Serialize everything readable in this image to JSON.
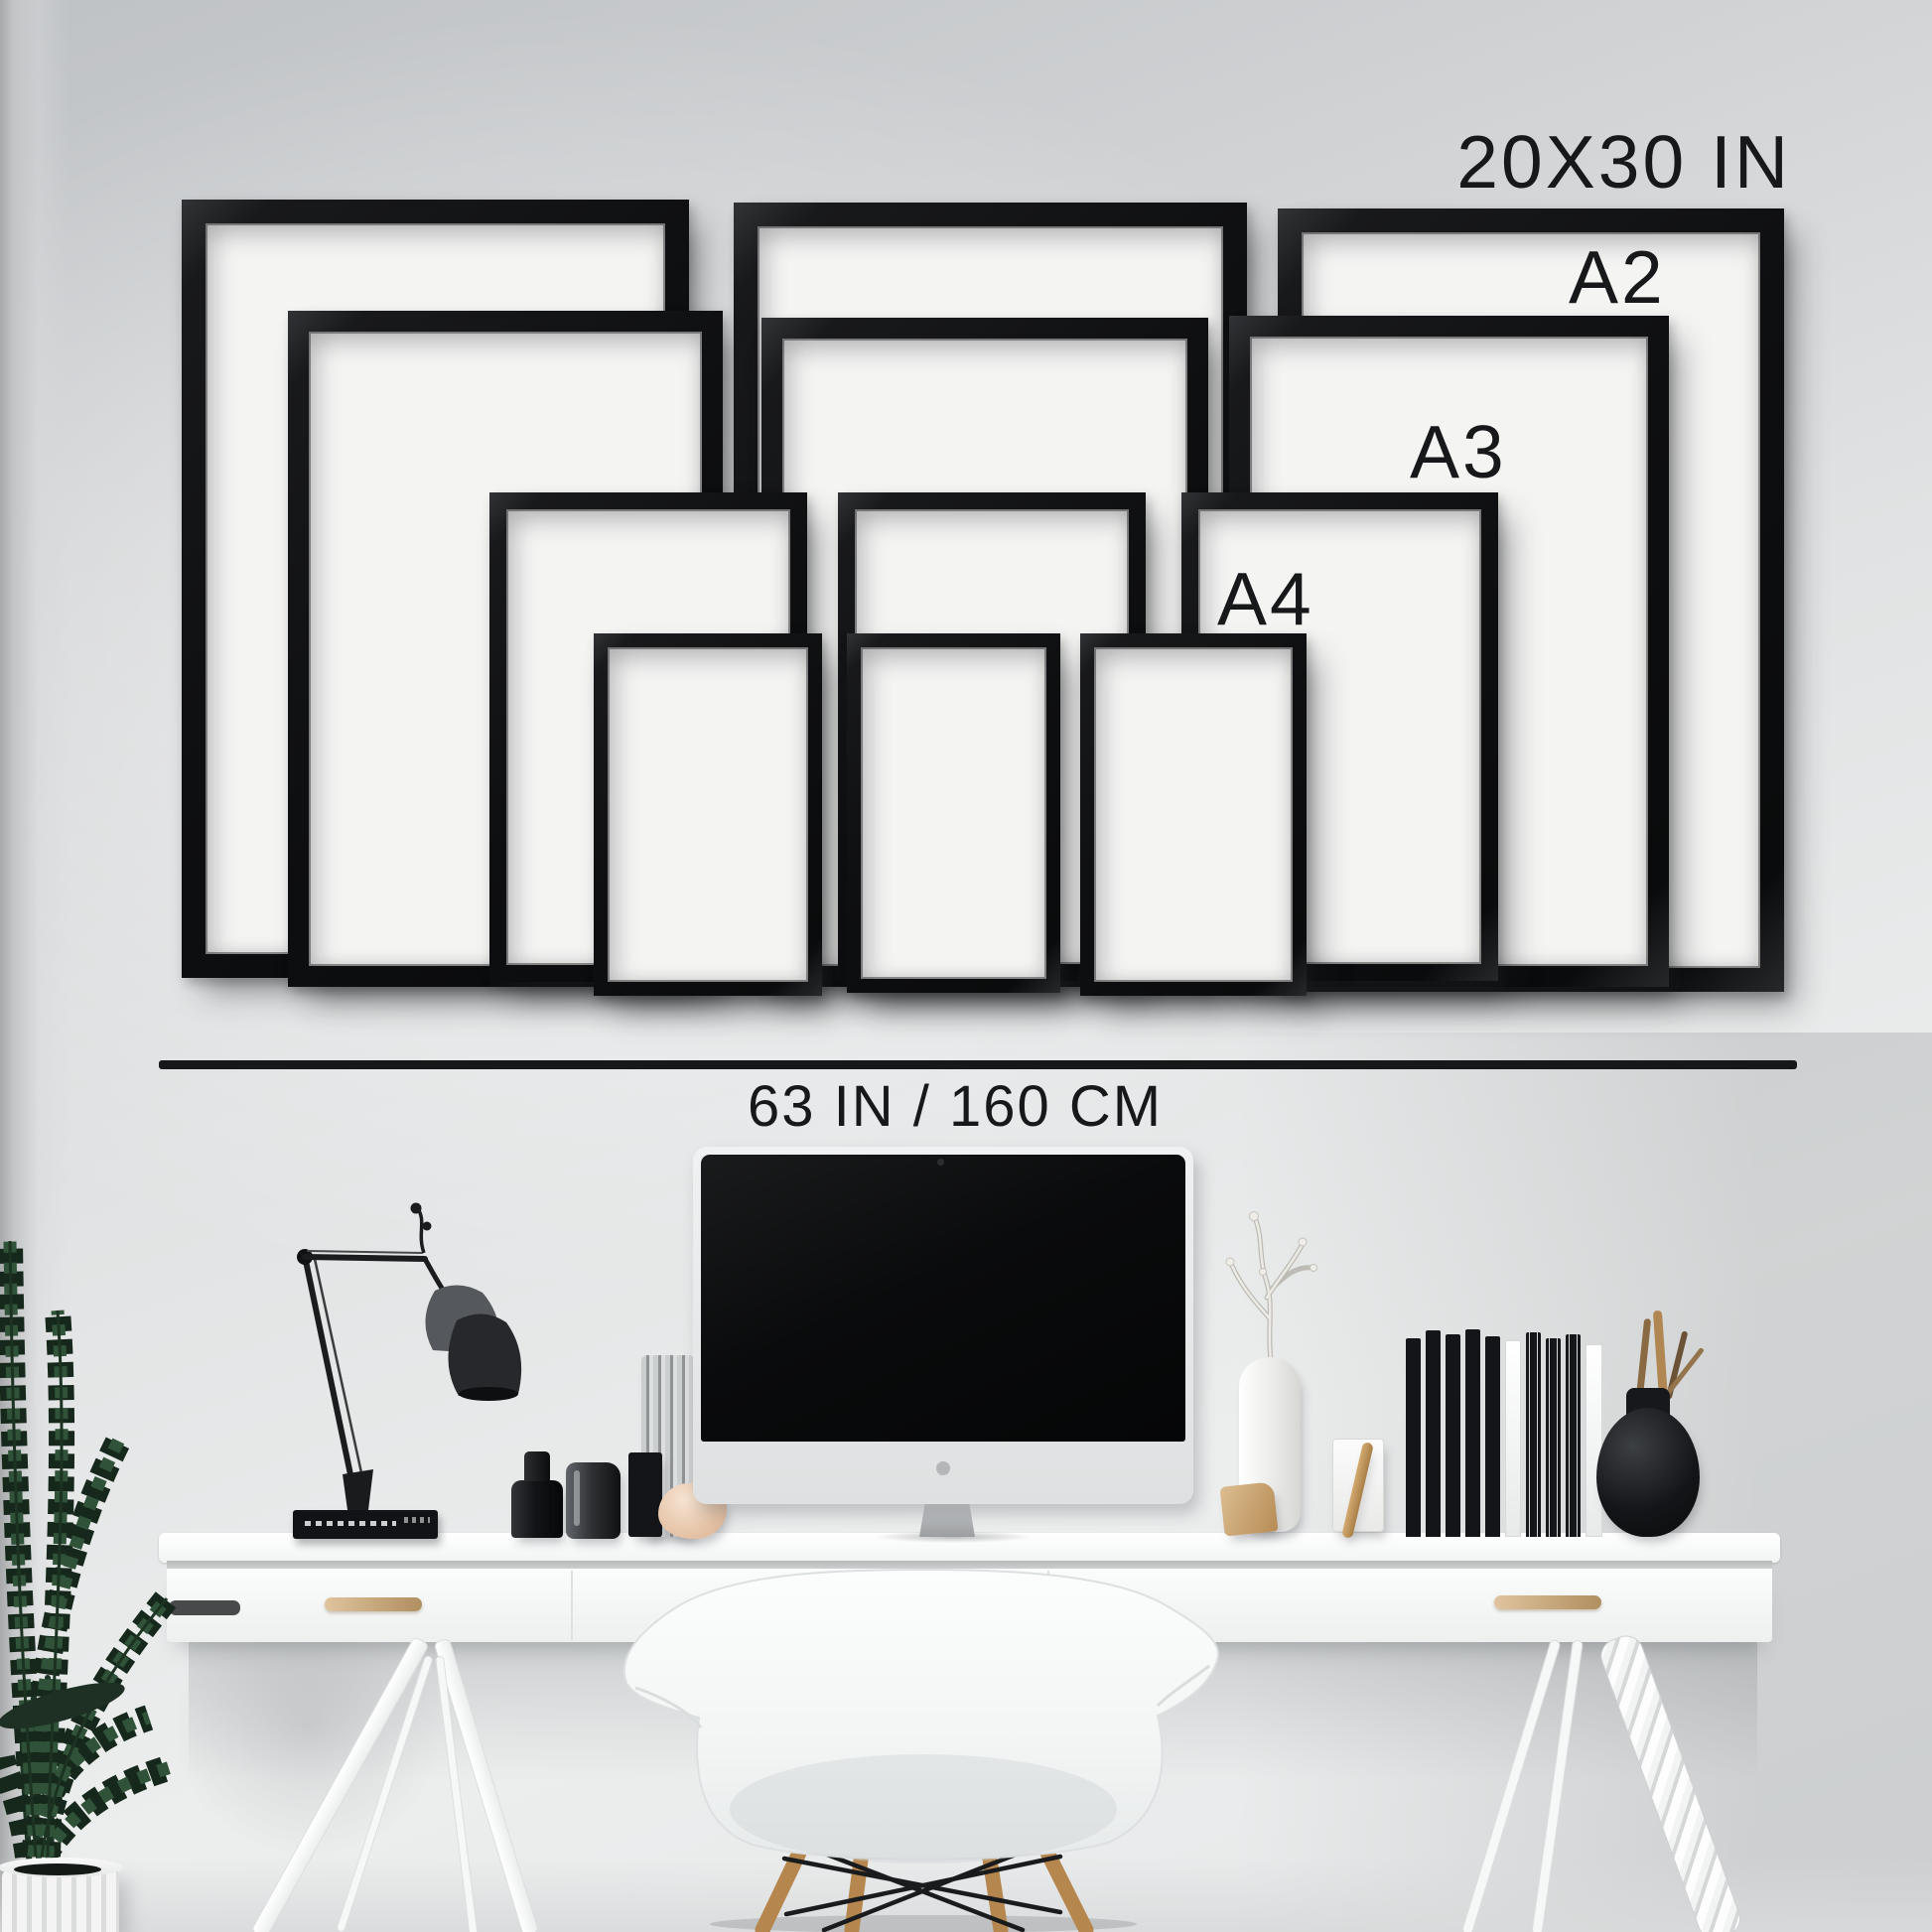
{
  "title": "Black picture frames size guide wall mockup",
  "size_guide": {
    "frame_labels": [
      {
        "id": "size-20x30",
        "text": "20X30 IN"
      },
      {
        "id": "size-a2",
        "text": "A2"
      },
      {
        "id": "size-a3",
        "text": "A3"
      },
      {
        "id": "size-a4",
        "text": "A4"
      }
    ],
    "width_measurement": {
      "text": "63 IN / 160 CM"
    },
    "columns": 3,
    "frames_per_column": 4
  },
  "scene": {
    "objects": [
      "potted-plant",
      "woven-white-planter",
      "anglepoise-desk-lamp",
      "black-book-stack",
      "matte-black-bottle",
      "dark-glass-vase",
      "textured-glass-cylinder",
      "black-pen-cup",
      "coral-sculpture",
      "imac-computer",
      "white-branch-vase",
      "wood-wedge",
      "marble-card-holder",
      "leaning-wood-stick",
      "black-record-organizer",
      "round-black-vase-with-twigs",
      "white-trestle-desk",
      "braided-desk-leg",
      "white-eames-armchair"
    ]
  },
  "colors": {
    "frame_black": "#0e0f11",
    "paper_white": "#f4f4f3",
    "wall_light": "#eceeee",
    "wall_dark": "#bfc2c5",
    "text": "#17181a",
    "desk_white": "#fbfcfc",
    "handle_brass": "#c8a97e",
    "chair_white": "#f5f6f6",
    "wood_leg": "#b5874e",
    "plant_green": "#2f5238"
  }
}
